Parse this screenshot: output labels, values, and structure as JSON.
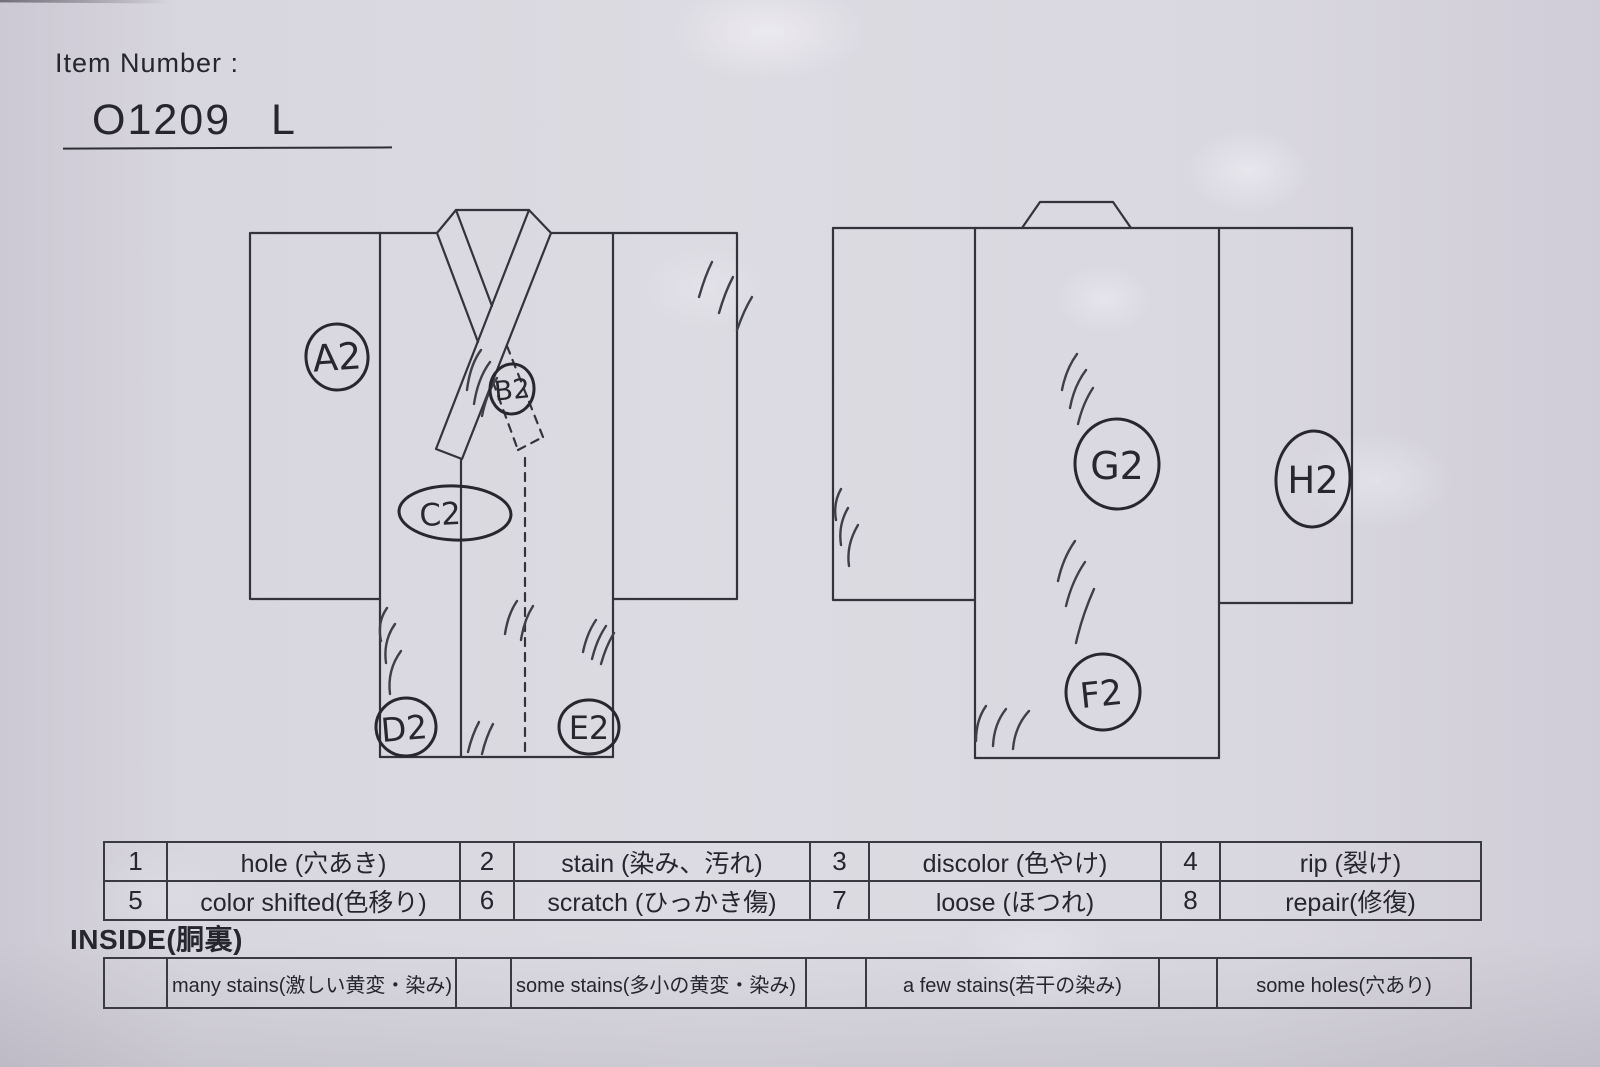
{
  "header": {
    "label": "Item Number :",
    "item_number": "O1209 L"
  },
  "markers": [
    {
      "id": "A2"
    },
    {
      "id": "B2"
    },
    {
      "id": "C2"
    },
    {
      "id": "D2"
    },
    {
      "id": "E2"
    },
    {
      "id": "F2"
    },
    {
      "id": "G2"
    },
    {
      "id": "H2"
    }
  ],
  "legend": {
    "items": [
      {
        "num": "1",
        "label": "hole (穴あき)"
      },
      {
        "num": "2",
        "label": "stain (染み、汚れ)"
      },
      {
        "num": "3",
        "label": "discolor (色やけ)"
      },
      {
        "num": "4",
        "label": "rip (裂け)"
      },
      {
        "num": "5",
        "label": "color shifted(色移り)"
      },
      {
        "num": "6",
        "label": "scratch (ひっかき傷)"
      },
      {
        "num": "7",
        "label": "loose (ほつれ)"
      },
      {
        "num": "8",
        "label": "repair(修復)"
      }
    ]
  },
  "inside": {
    "heading": "INSIDE(胴裏)",
    "items": [
      {
        "label": "many stains(激しい黄変・染み)"
      },
      {
        "label": "some stains(多小の黄変・染み)"
      },
      {
        "label": "a few stains(若干の染み)"
      },
      {
        "label": "some holes(穴あり)"
      }
    ]
  },
  "colors": {
    "paper": "#d8d6de",
    "ink": "#33333b",
    "pen": "#27272d"
  }
}
